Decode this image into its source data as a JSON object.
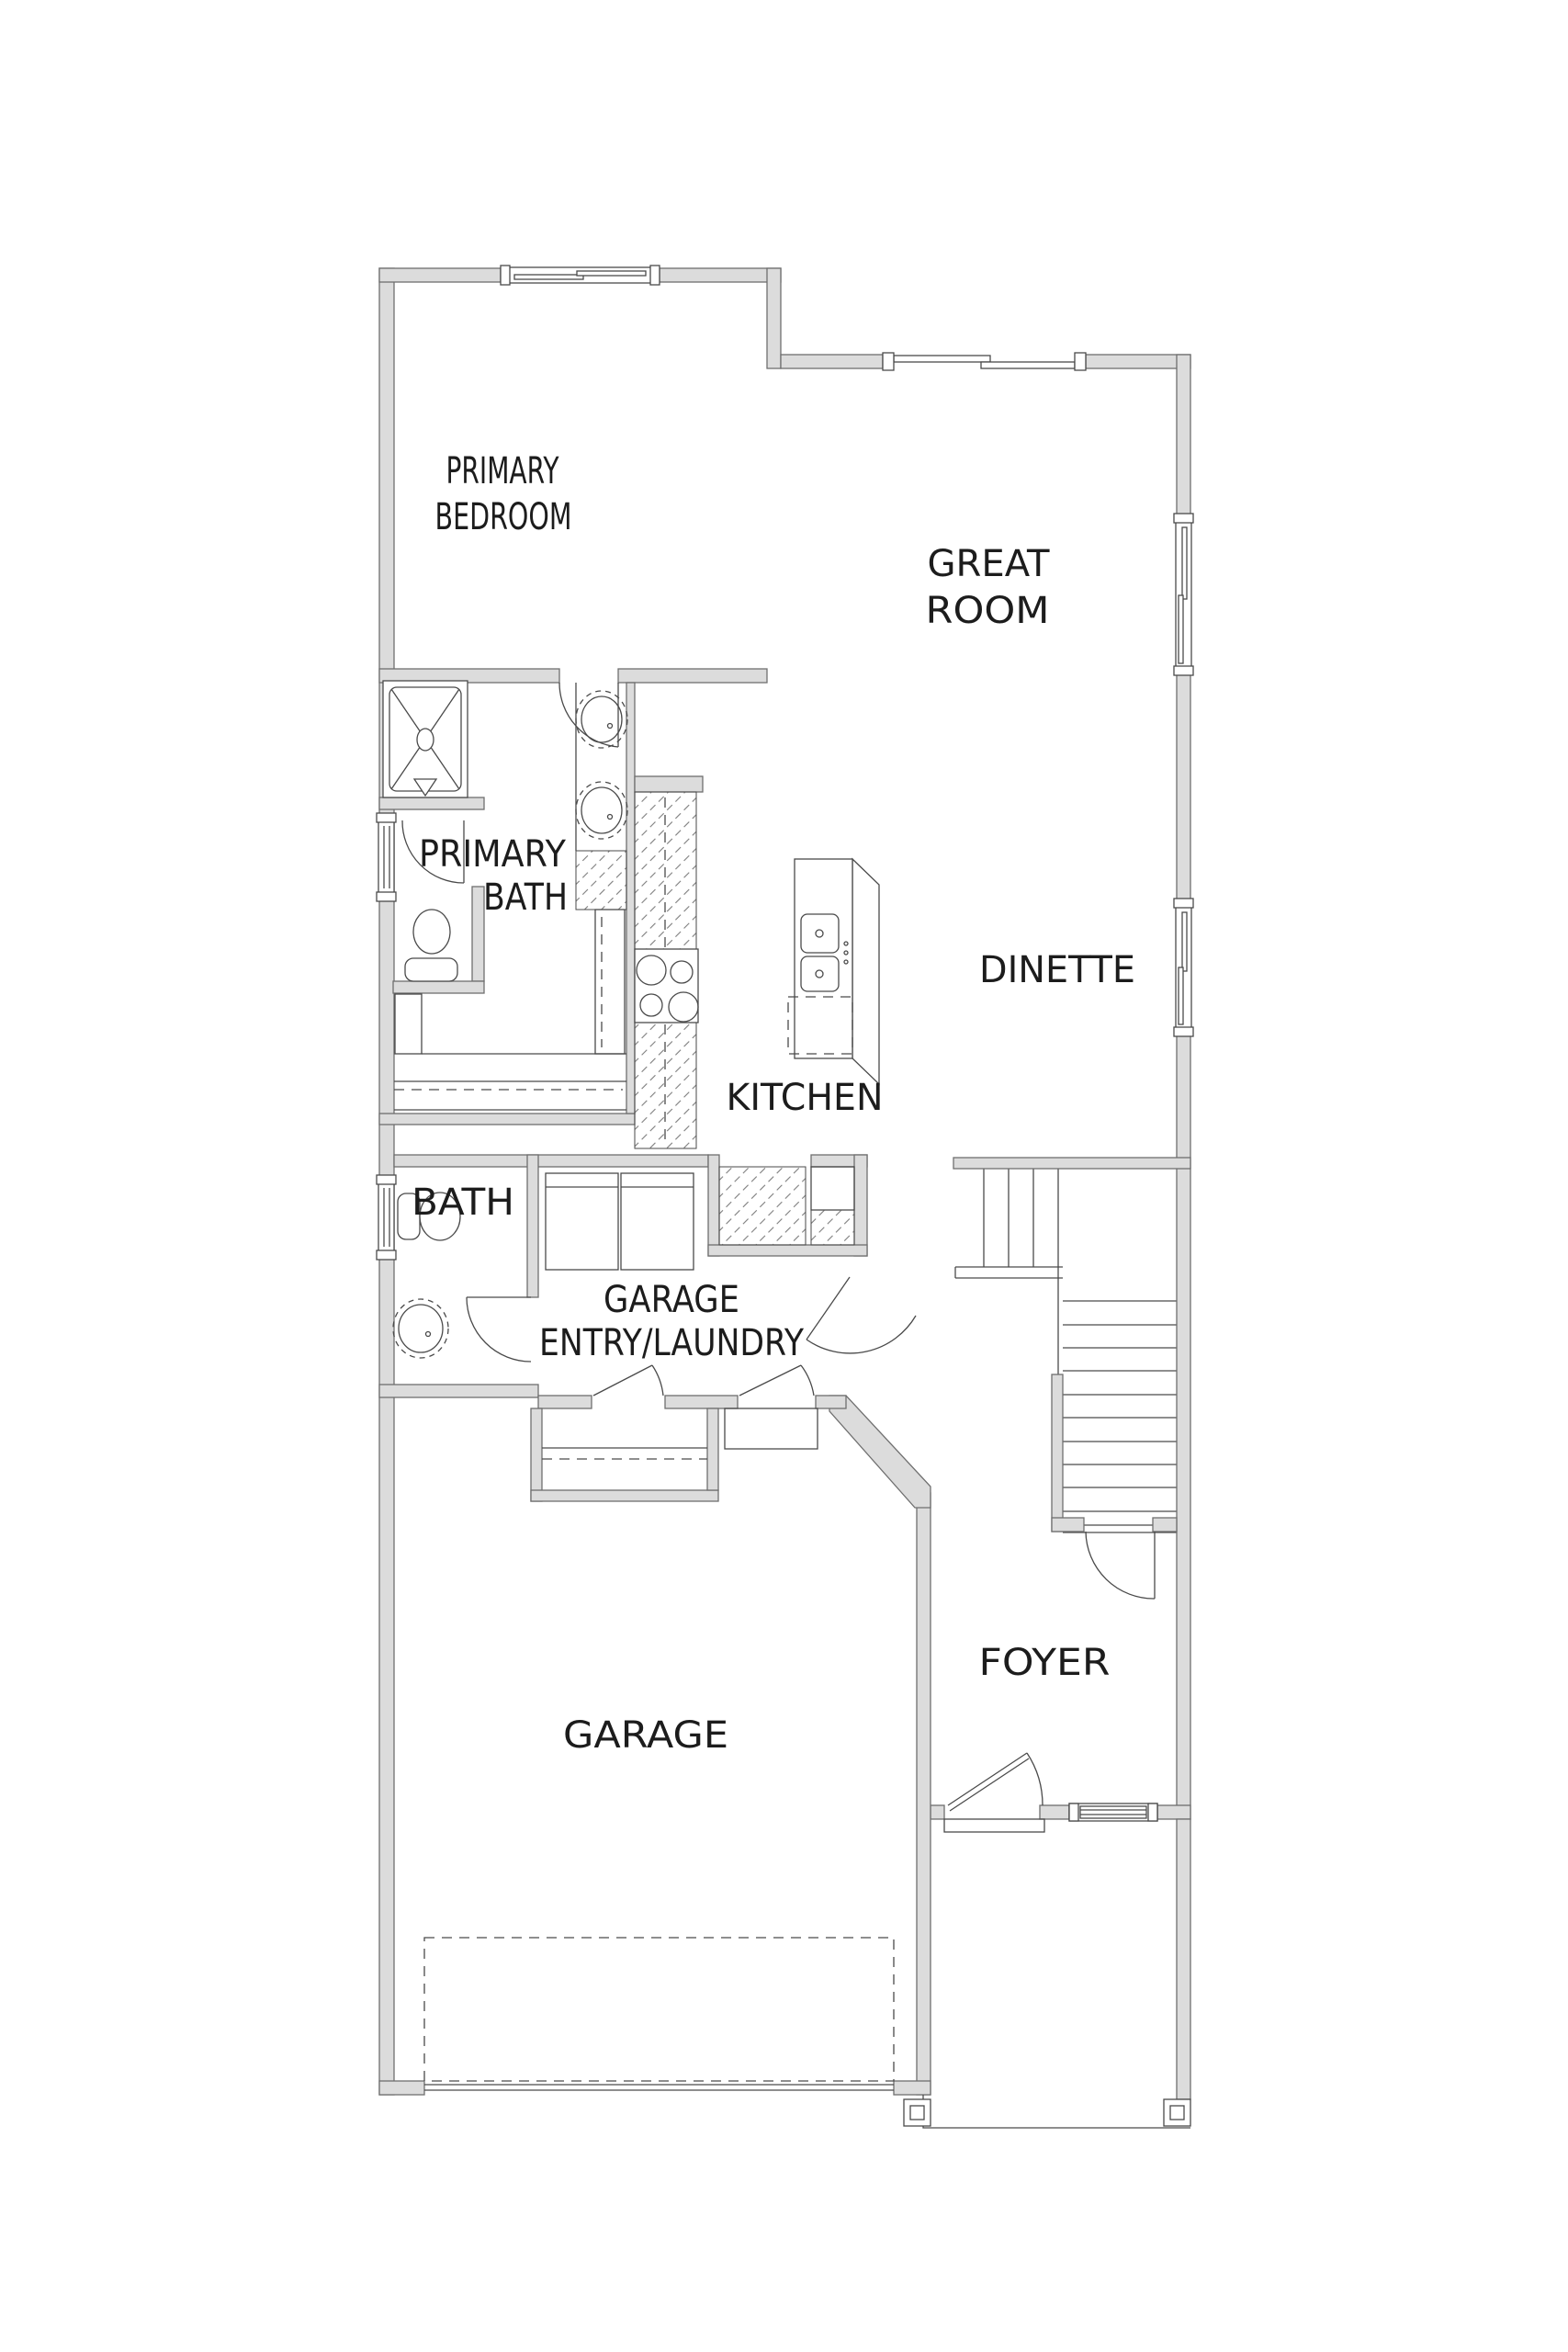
{
  "page": {
    "type": "architectural-floor-plan",
    "background": "#ffffff"
  },
  "colors": {
    "background": "#ffffff",
    "wall_fill": "#dcdcdc",
    "wall_stroke": "#6f6f6f",
    "line": "#4a4a4a",
    "label": "#1c1c1c"
  },
  "rooms": [
    {
      "name": "primary-bedroom",
      "lines": [
        "PRIMARY",
        "BEDROOM"
      ]
    },
    {
      "name": "great-room",
      "lines": [
        "GREAT",
        "ROOM"
      ]
    },
    {
      "name": "primary-bath",
      "lines": [
        "PRIMARY",
        "BATH"
      ]
    },
    {
      "name": "dinette",
      "lines": [
        "DINETTE"
      ]
    },
    {
      "name": "kitchen",
      "lines": [
        "KITCHEN"
      ]
    },
    {
      "name": "bath",
      "lines": [
        "BATH"
      ]
    },
    {
      "name": "garage-entry-laundry",
      "lines": [
        "GARAGE",
        "ENTRY/LAUNDRY"
      ]
    },
    {
      "name": "garage",
      "lines": [
        "GARAGE"
      ]
    },
    {
      "name": "foyer",
      "lines": [
        "FOYER"
      ]
    }
  ],
  "fixtures": [
    "shower",
    "toilet",
    "vanity-double-sink",
    "pedestal-sink",
    "linen-closet",
    "closet-rod",
    "cooktop",
    "kitchen-island-double-sink",
    "dishwasher",
    "washer",
    "dryer",
    "pantry-cabinets",
    "stairs",
    "interior-doors",
    "sliding-patio-door",
    "sliding-windows",
    "entry-door-with-sidelite",
    "garage-overhead-door",
    "porch-posts",
    "garage-stoop"
  ]
}
